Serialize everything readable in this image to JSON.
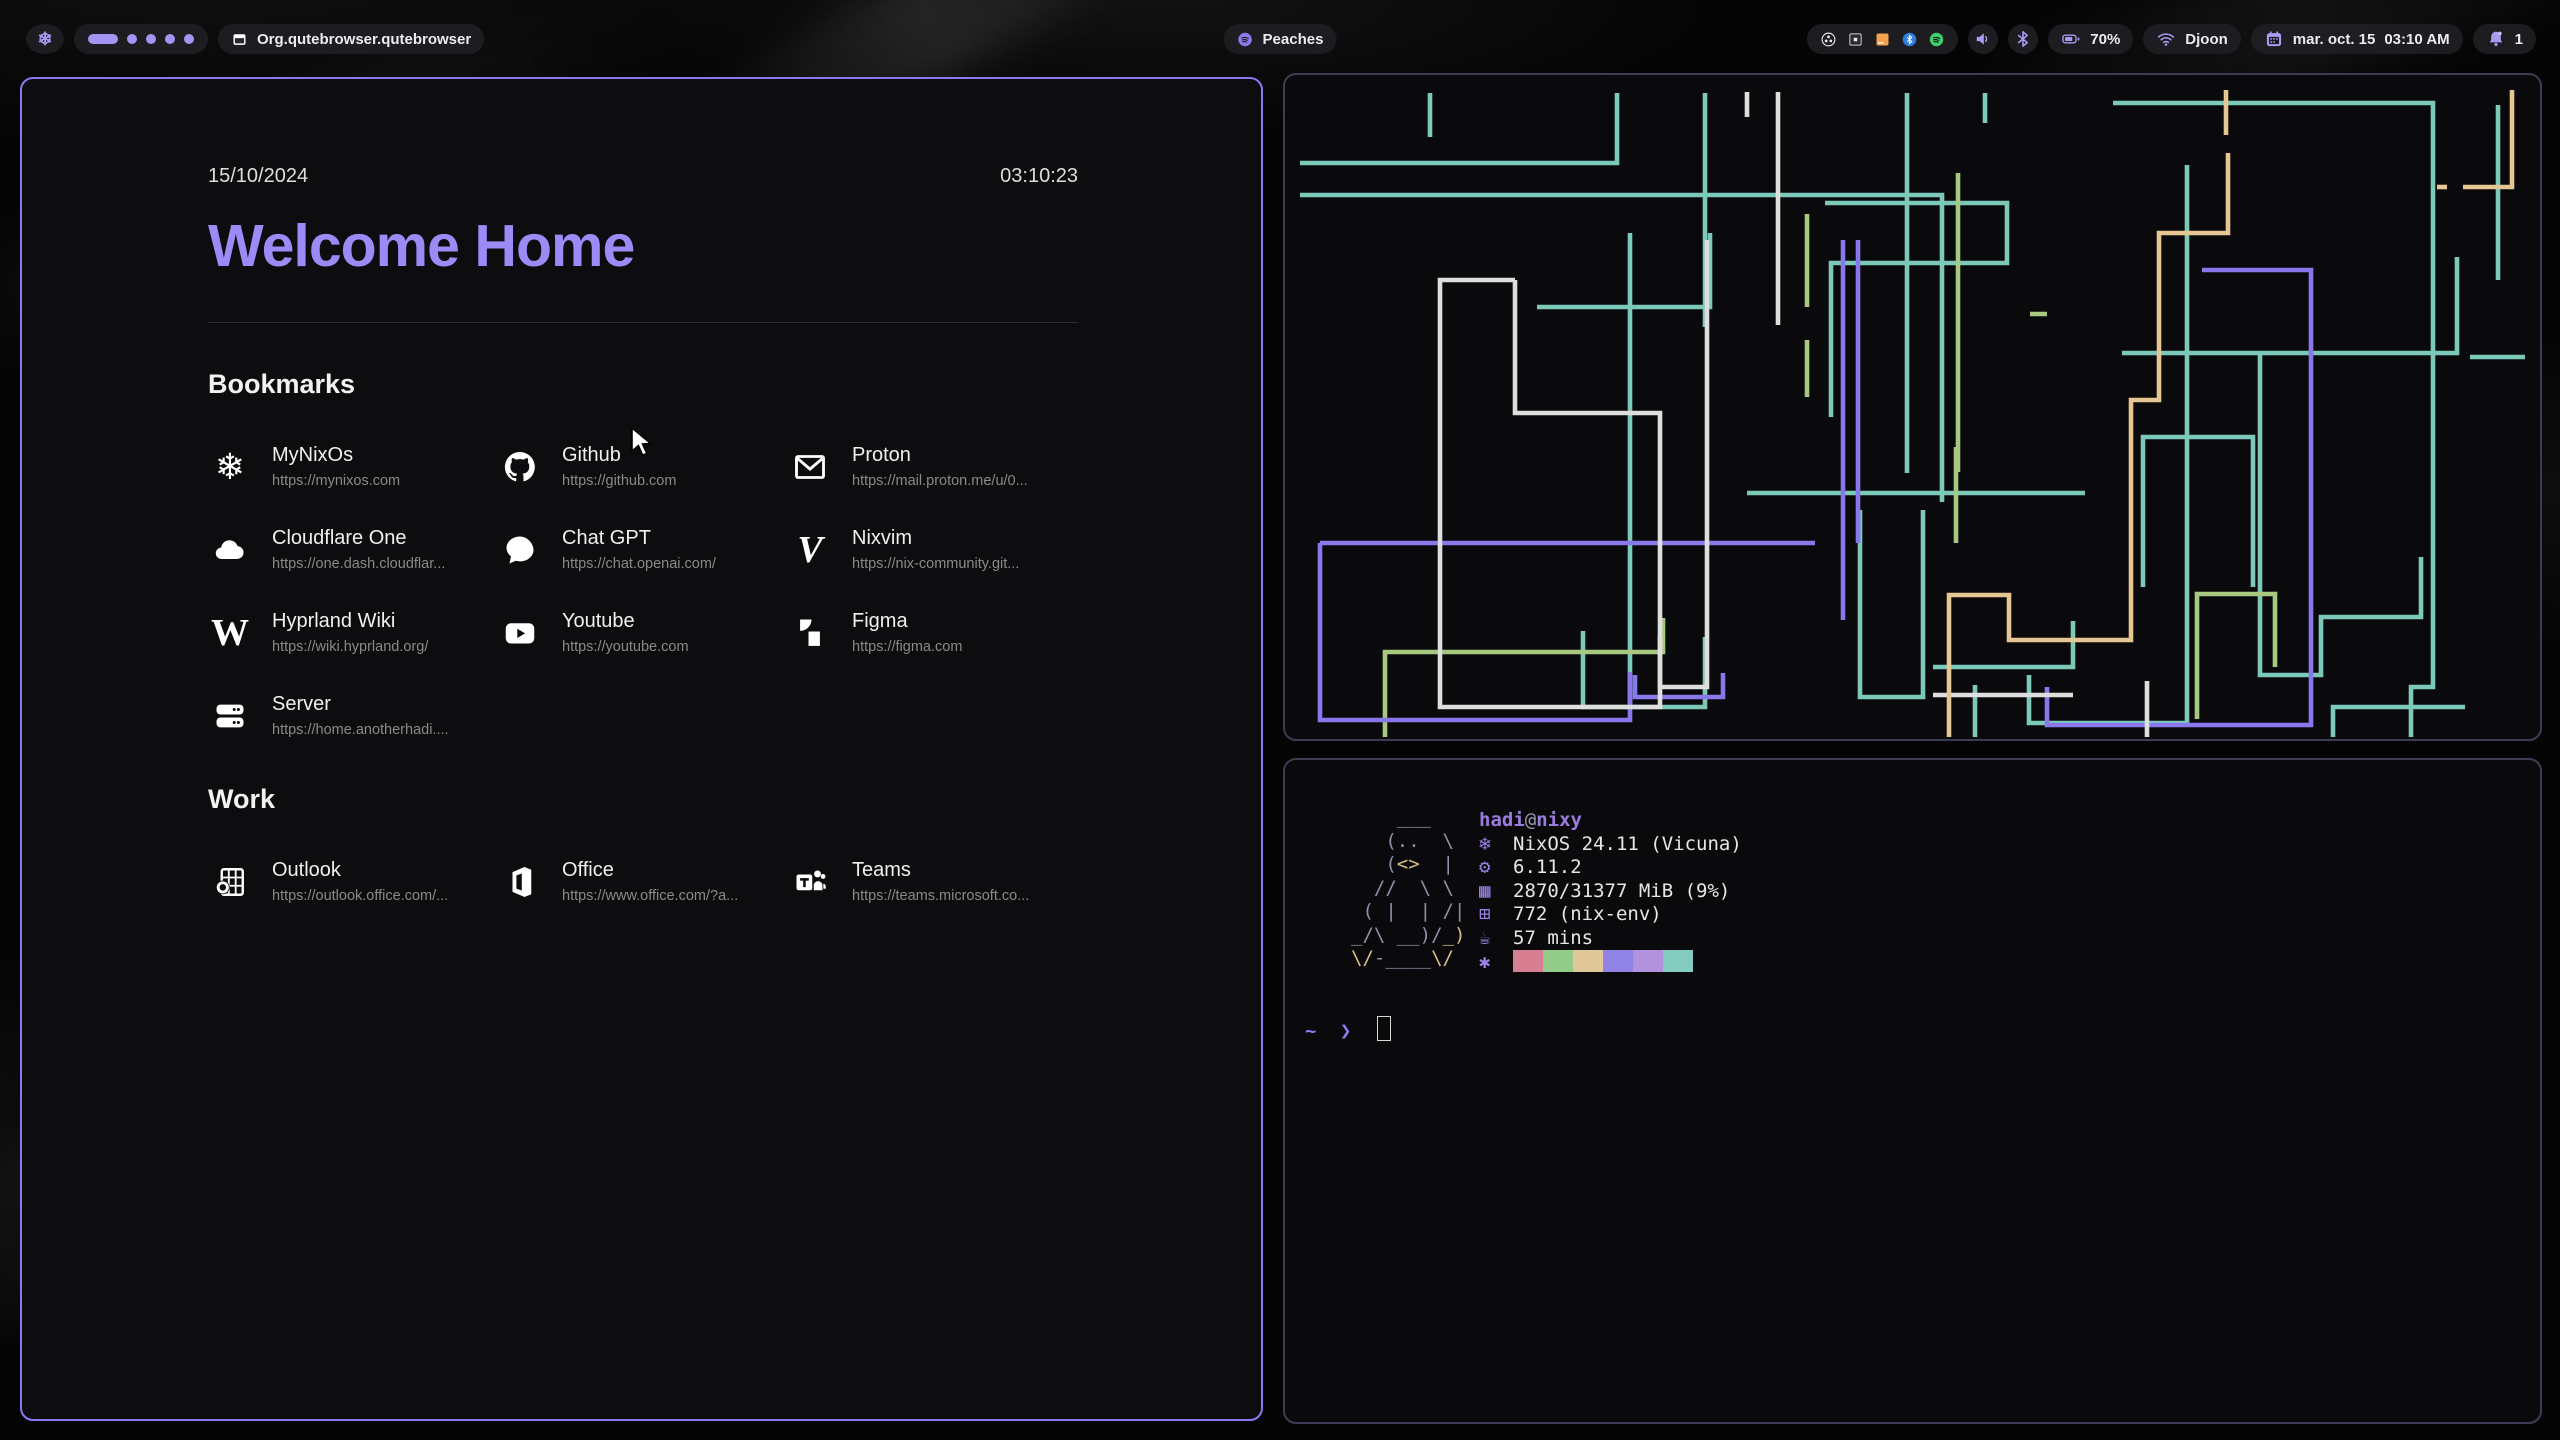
{
  "topbar": {
    "window_title": "Org.qutebrowser.qutebrowser",
    "media": {
      "label": "Peaches"
    },
    "workspaces": {
      "active_index": 0,
      "count": 5
    },
    "battery": {
      "percent": "70%"
    },
    "network": {
      "ssid": "Djoon"
    },
    "clock": {
      "date": "mar. oct. 15",
      "time": "03:10 AM"
    },
    "notifications": {
      "count": "1"
    },
    "accent": "#a395f2"
  },
  "browser": {
    "date": "15/10/2024",
    "time": "03:10:23",
    "title": "Welcome Home",
    "sections": [
      {
        "heading": "Bookmarks",
        "items": [
          {
            "name": "MyNixOs",
            "url": "https://mynixos.com",
            "icon": "nix"
          },
          {
            "name": "Github",
            "url": "https://github.com",
            "icon": "github"
          },
          {
            "name": "Proton",
            "url": "https://mail.proton.me/u/0...",
            "icon": "mail"
          },
          {
            "name": "Cloudflare One",
            "url": "https://one.dash.cloudflar...",
            "icon": "cloud"
          },
          {
            "name": "Chat GPT",
            "url": "https://chat.openai.com/",
            "icon": "chat"
          },
          {
            "name": "Nixvim",
            "url": "https://nix-community.git...",
            "icon": "vim"
          },
          {
            "name": "Hyprland Wiki",
            "url": "https://wiki.hyprland.org/",
            "icon": "wiki"
          },
          {
            "name": "Youtube",
            "url": "https://youtube.com",
            "icon": "youtube"
          },
          {
            "name": "Figma",
            "url": "https://figma.com",
            "icon": "figma"
          },
          {
            "name": "Server",
            "url": "https://home.anotherhadi....",
            "icon": "server"
          }
        ]
      },
      {
        "heading": "Work",
        "items": [
          {
            "name": "Outlook",
            "url": "https://outlook.office.com/...",
            "icon": "outlook"
          },
          {
            "name": "Office",
            "url": "https://www.office.com/?a...",
            "icon": "office"
          },
          {
            "name": "Teams",
            "url": "https://teams.microsoft.co...",
            "icon": "teams"
          }
        ]
      }
    ]
  },
  "pipes_terminal": {
    "colors": {
      "teal": "#7cc8b9",
      "green": "#a6c87f",
      "purple": "#8878ec",
      "white": "#dedede",
      "tan": "#e6c693"
    },
    "pipes": [
      {
        "c": "teal",
        "p": "15,120 657,120 657,427"
      },
      {
        "c": "teal",
        "p": "15,88 332,88 332,18"
      },
      {
        "c": "teal",
        "p": "252,232 425,232 425,158"
      },
      {
        "c": "teal",
        "p": "345,158 345,630"
      },
      {
        "c": "teal",
        "p": "420,18 420,252"
      },
      {
        "c": "teal",
        "p": "540,128 722,128 722,188 546,188 546,342"
      },
      {
        "c": "teal",
        "p": "622,18 622,398"
      },
      {
        "c": "teal",
        "p": "828,28 1148,28 1148,612 1126,612 1126,662"
      },
      {
        "c": "teal",
        "p": "902,90 902,648 744,648 744,600"
      },
      {
        "c": "teal",
        "p": "837,278 1172,278 1172,182"
      },
      {
        "c": "teal",
        "p": "975,280 975,600 1036,600 1036,542 1136,542 1136,482"
      },
      {
        "c": "teal",
        "p": "575,435 575,622 638,622 638,435"
      },
      {
        "c": "teal",
        "p": "298,556 298,632 420,632 420,562"
      },
      {
        "c": "teal",
        "p": "462,418 800,418"
      },
      {
        "c": "teal",
        "p": "648,592 788,592 788,546"
      },
      {
        "c": "teal",
        "p": "858,512 858,362 968,362 968,512"
      },
      {
        "c": "teal",
        "p": "1048,662 1048,632 1180,632"
      },
      {
        "c": "teal",
        "p": "700,18 700,48"
      },
      {
        "c": "teal",
        "p": "145,18 145,62"
      },
      {
        "c": "teal",
        "p": "690,610 690,662"
      },
      {
        "c": "teal",
        "p": "1213,30 1213,205"
      },
      {
        "c": "teal",
        "p": "1185,282 1240,282"
      },
      {
        "c": "green",
        "p": "522,139 522,232"
      },
      {
        "c": "green",
        "p": "522,265 522,322"
      },
      {
        "c": "green",
        "p": "673,98 673,397"
      },
      {
        "c": "green",
        "p": "745,239 762,239"
      },
      {
        "c": "green",
        "p": "671,372 671,468"
      },
      {
        "c": "green",
        "p": "100,662 100,577 378,577 378,543"
      },
      {
        "c": "green",
        "p": "912,644 912,519 990,519 990,592"
      },
      {
        "c": "purple",
        "p": "35,468 530,468"
      },
      {
        "c": "purple",
        "p": "35,468 35,645 345,645 345,597"
      },
      {
        "c": "purple",
        "p": "558,165 558,545"
      },
      {
        "c": "purple",
        "p": "573,165 573,468"
      },
      {
        "c": "purple",
        "p": "917,195 1026,195 1026,650 762,650 762,612"
      },
      {
        "c": "purple",
        "p": "350,600 350,622 438,622 438,598"
      },
      {
        "c": "white",
        "p": "230,205 155,205 155,632 375,632 375,560"
      },
      {
        "c": "white",
        "p": "230,205 230,338 375,338 375,612 422,612 422,165"
      },
      {
        "c": "white",
        "p": "648,620 788,620"
      },
      {
        "c": "white",
        "p": "862,606 862,662"
      },
      {
        "c": "white",
        "p": "462,17 462,42"
      },
      {
        "c": "white",
        "p": "493,17 493,250"
      },
      {
        "c": "tan",
        "p": "941,15 941,60"
      },
      {
        "c": "tan",
        "p": "943,78 943,158 874,158 874,325 846,325 846,565 724,565 724,520 664,520 664,662"
      },
      {
        "c": "tan",
        "p": "1227,15 1227,112 1178,112"
      },
      {
        "c": "tan",
        "p": "1152,112 1162,112"
      }
    ]
  },
  "fetch_terminal": {
    "user": "hadi",
    "at": "@",
    "host": "nixy",
    "ascii": [
      [
        [
          "    ___",
          "g"
        ]
      ],
      [
        [
          "   (..  \\",
          "g"
        ]
      ],
      [
        [
          "   (",
          "g"
        ],
        [
          "<>",
          "t"
        ],
        [
          "  |",
          "g"
        ]
      ],
      [
        [
          "  //  \\ \\",
          "g"
        ]
      ],
      [
        [
          " ( |  | /|",
          "g"
        ]
      ],
      [
        [
          "_/\\ __)/",
          "g"
        ],
        [
          "_)",
          "t"
        ]
      ],
      [
        [
          "\\/",
          "t"
        ],
        [
          "-____",
          "g"
        ],
        [
          "\\/",
          "t"
        ]
      ]
    ],
    "rows": [
      {
        "icon": "❄",
        "name": "os",
        "text": "NixOS 24.11 (Vicuna)"
      },
      {
        "icon": "⚙",
        "name": "kernel",
        "text": "6.11.2"
      },
      {
        "icon": "▦",
        "name": "memory",
        "text": "2870/31377 MiB (9%)"
      },
      {
        "icon": "⊞",
        "name": "packages",
        "text": "772 (nix-env)"
      },
      {
        "icon": "☕",
        "name": "uptime",
        "text": "57 mins"
      }
    ],
    "palette_icon": "✱",
    "palette": [
      "#d87e93",
      "#93cb8b",
      "#e0c89b",
      "#9183e6",
      "#b292dc",
      "#84cbc0"
    ],
    "prompt": {
      "cwd": "~",
      "symbol": "❯"
    }
  }
}
